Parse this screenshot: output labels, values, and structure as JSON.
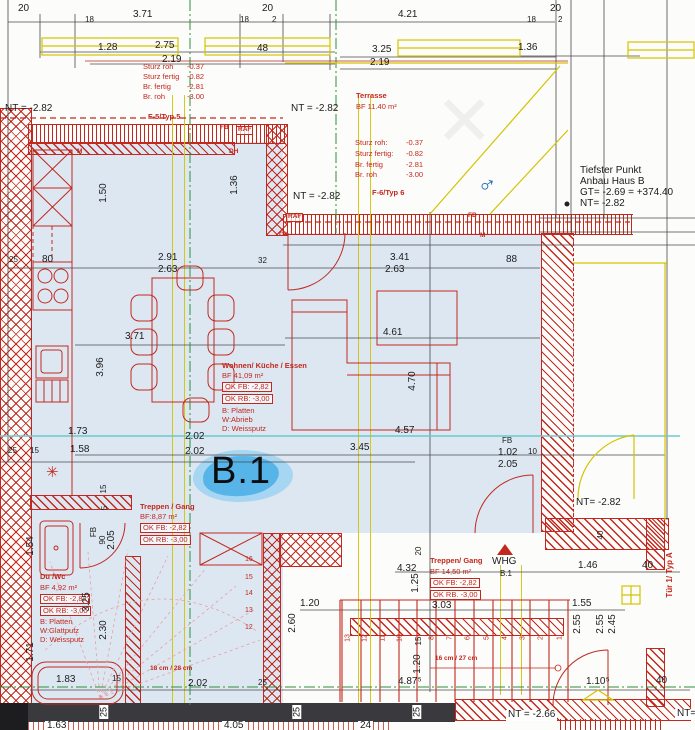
{
  "title": "Grundriss Wohnung B.1 (Erdgeschoss-Ausschnitt)",
  "colors": {
    "red": "#c2281e",
    "yellow": "#d4c400",
    "green": "#2e8f3c",
    "cyan": "#6cc9cf",
    "floor": "#dde7f2",
    "dark": "#3a3a3e",
    "blob": "#57b4e8",
    "blob_light": "#a7d6f2",
    "bluemark": "#1f6fb5"
  },
  "marker": {
    "unit_label": "B.1"
  },
  "rooms": [
    {
      "name": "Wohnen/ Küche / Essen",
      "area": "BF 41,09 m²",
      "ok_fb": "OK FB: -2,82",
      "ok_rb": "OK RB: -3,00"
    },
    {
      "name": "Treppen / Gang",
      "area": "BF:8,87 m²",
      "ok_fb": "OK FB: -2,82",
      "ok_rb": "OK RB: -3,00"
    },
    {
      "name": "Du /Wc",
      "area": "BF 4,92 m²",
      "ok_fb": "OK FB: -2,82",
      "ok_rb": "OK RB: -3,00"
    },
    {
      "name": "Treppen/ Gang",
      "area": "BF 14,50 m²",
      "ok_fb": "OK FB: -2,82",
      "ok_rb": "OK RB. -3,00"
    },
    {
      "name": "Terrasse",
      "area": "BF 11.40 m²"
    }
  ],
  "annotations": [
    {
      "n": "dim-20-topleft",
      "t": "20",
      "x": 18,
      "y": 4,
      "c": "d"
    },
    {
      "n": "dim-18",
      "t": "18",
      "x": 85,
      "y": 16,
      "c": "ds"
    },
    {
      "n": "dim-371-top",
      "t": "3.71",
      "x": 133,
      "y": 10,
      "c": "d"
    },
    {
      "n": "dim-20-mid",
      "t": "20",
      "x": 262,
      "y": 4,
      "c": "d"
    },
    {
      "n": "dim-18b",
      "t": "18",
      "x": 240,
      "y": 16,
      "c": "ds"
    },
    {
      "n": "dim-2a",
      "t": "2",
      "x": 272,
      "y": 16,
      "c": "ds"
    },
    {
      "n": "dim-421",
      "t": "4.21",
      "x": 398,
      "y": 10,
      "c": "d"
    },
    {
      "n": "dim-20-right",
      "t": "20",
      "x": 550,
      "y": 4,
      "c": "d"
    },
    {
      "n": "dim-18c",
      "t": "18",
      "x": 527,
      "y": 16,
      "c": "ds"
    },
    {
      "n": "dim-2b",
      "t": "2",
      "x": 558,
      "y": 16,
      "c": "ds"
    },
    {
      "n": "dim-128",
      "t": "1.28",
      "x": 98,
      "y": 43,
      "c": "d"
    },
    {
      "n": "dim-275",
      "t": "2.75",
      "x": 155,
      "y": 41,
      "c": "d"
    },
    {
      "n": "dim-219a",
      "t": "2.19",
      "x": 162,
      "y": 55,
      "c": "d"
    },
    {
      "n": "dim-48",
      "t": "48",
      "x": 257,
      "y": 44,
      "c": "d"
    },
    {
      "n": "dim-325",
      "t": "3.25",
      "x": 372,
      "y": 45,
      "c": "d"
    },
    {
      "n": "dim-219b",
      "t": "2.19",
      "x": 370,
      "y": 58,
      "c": "d"
    },
    {
      "n": "dim-136",
      "t": "1.36",
      "x": 518,
      "y": 43,
      "c": "d"
    },
    {
      "n": "spec1-l1",
      "t": "Sturz roh",
      "x": 143,
      "y": 63,
      "c": "r"
    },
    {
      "n": "spec1-v1",
      "t": "-0.37",
      "x": 187,
      "y": 63,
      "c": "r"
    },
    {
      "n": "spec1-l2",
      "t": "Sturz fertig",
      "x": 143,
      "y": 73,
      "c": "r"
    },
    {
      "n": "spec1-v2",
      "t": "-0.82",
      "x": 187,
      "y": 73,
      "c": "r"
    },
    {
      "n": "spec1-l3",
      "t": "Br. fertig",
      "x": 143,
      "y": 83,
      "c": "r"
    },
    {
      "n": "spec1-v3",
      "t": "-2.81",
      "x": 187,
      "y": 83,
      "c": "r"
    },
    {
      "n": "spec1-l4",
      "t": "Br. roh",
      "x": 143,
      "y": 93,
      "c": "r"
    },
    {
      "n": "spec1-v4",
      "t": "-3.00",
      "x": 187,
      "y": 93,
      "c": "r"
    },
    {
      "n": "window-type-5",
      "t": "F-5/Typ 5",
      "x": 148,
      "y": 113,
      "c": "rbold"
    },
    {
      "n": "level-nt-1",
      "t": "NT = -2.82",
      "x": 5,
      "y": 104,
      "c": "d"
    },
    {
      "n": "level-nt-2",
      "t": "NT = -2.82",
      "x": 291,
      "y": 104,
      "c": "d"
    },
    {
      "n": "room-terrasse",
      "t": "Terrasse",
      "x": 356,
      "y": 92,
      "c": "rbold"
    },
    {
      "n": "room-terrasse-area",
      "t": "BF 11.40 m²",
      "x": 356,
      "y": 103,
      "c": "r"
    },
    {
      "n": "spec2-l1",
      "t": "Sturz roh:",
      "x": 355,
      "y": 139,
      "c": "r"
    },
    {
      "n": "spec2-v1",
      "t": "-0.37",
      "x": 406,
      "y": 139,
      "c": "r"
    },
    {
      "n": "spec2-l2",
      "t": "Sturz fertig:",
      "x": 355,
      "y": 150,
      "c": "r"
    },
    {
      "n": "spec2-v2",
      "t": "-0.82",
      "x": 406,
      "y": 150,
      "c": "r"
    },
    {
      "n": "spec2-l3",
      "t": "Br. fertig",
      "x": 355,
      "y": 161,
      "c": "r"
    },
    {
      "n": "spec2-v3",
      "t": "-2.81",
      "x": 406,
      "y": 161,
      "c": "r"
    },
    {
      "n": "spec2-l4",
      "t": "Br. roh",
      "x": 355,
      "y": 171,
      "c": "r"
    },
    {
      "n": "spec2-v4",
      "t": "-3.00",
      "x": 406,
      "y": 171,
      "c": "r"
    },
    {
      "n": "window-type-6",
      "t": "F-6/Typ 6",
      "x": 372,
      "y": 189,
      "c": "rbold"
    },
    {
      "n": "level-nt-3",
      "t": "NT = -2.82",
      "x": 293,
      "y": 192,
      "c": "d"
    },
    {
      "n": "note-tiefster-1",
      "t": "Tiefster Punkt",
      "x": 580,
      "y": 166,
      "c": "d"
    },
    {
      "n": "note-tiefster-2",
      "t": "Anbau Haus B",
      "x": 580,
      "y": 177,
      "c": "d"
    },
    {
      "n": "note-tiefster-3",
      "t": "GT= -2.69 = +374.40",
      "x": 580,
      "y": 188,
      "c": "d"
    },
    {
      "n": "note-tiefster-4",
      "t": "NT= -2.82",
      "x": 580,
      "y": 199,
      "c": "d"
    },
    {
      "n": "tag-fb-1",
      "t": "FB",
      "x": 220,
      "y": 125,
      "c": "rs"
    },
    {
      "n": "tag-raf-1",
      "t": "RAF",
      "x": 236,
      "y": 126,
      "c": "rsb"
    },
    {
      "n": "tag-raf-2",
      "t": "RAF",
      "x": 286,
      "y": 213,
      "c": "rsb"
    },
    {
      "n": "tag-fb-2",
      "t": "FB",
      "x": 468,
      "y": 213,
      "c": "rs"
    },
    {
      "n": "tag-ok",
      "t": "OK",
      "x": 279,
      "y": 232,
      "c": "rs"
    },
    {
      "n": "tag-m-1",
      "t": "M",
      "x": 480,
      "y": 233,
      "c": "rs"
    },
    {
      "n": "tag-m-2",
      "t": "M",
      "x": 77,
      "y": 149,
      "c": "rs"
    },
    {
      "n": "tag-dh",
      "t": "DH",
      "x": 229,
      "y": 149,
      "c": "rs"
    },
    {
      "n": "dim-25a",
      "t": "25",
      "x": 9,
      "y": 256,
      "c": "ds"
    },
    {
      "n": "dim-80",
      "t": "80",
      "x": 42,
      "y": 255,
      "c": "d"
    },
    {
      "n": "dim-291",
      "t": "2.91",
      "x": 158,
      "y": 253,
      "c": "d"
    },
    {
      "n": "dim-263a",
      "t": "2.63",
      "x": 158,
      "y": 265,
      "c": "d"
    },
    {
      "n": "dim-32",
      "t": "32",
      "x": 258,
      "y": 257,
      "c": "ds"
    },
    {
      "n": "dim-341",
      "t": "3.41",
      "x": 390,
      "y": 253,
      "c": "d"
    },
    {
      "n": "dim-263b",
      "t": "2.63",
      "x": 385,
      "y": 265,
      "c": "d"
    },
    {
      "n": "dim-88",
      "t": "88",
      "x": 506,
      "y": 255,
      "c": "d"
    },
    {
      "n": "dim-150-v",
      "t": "1.50",
      "x": 104,
      "y": 193,
      "c": "dv"
    },
    {
      "n": "dim-136-v",
      "t": "1.36",
      "x": 235,
      "y": 185,
      "c": "dv"
    },
    {
      "n": "dim-371-mid",
      "t": "3.71",
      "x": 125,
      "y": 332,
      "c": "d"
    },
    {
      "n": "dim-396-v",
      "t": "3.96",
      "x": 101,
      "y": 367,
      "c": "dv"
    },
    {
      "n": "dim-461",
      "t": "4.61",
      "x": 383,
      "y": 328,
      "c": "d"
    },
    {
      "n": "dim-470-v",
      "t": "4.70",
      "x": 413,
      "y": 381,
      "c": "dv"
    },
    {
      "n": "room-wohnen",
      "t": "Wohnen/ Küche / Essen",
      "x": 222,
      "y": 362,
      "c": "rbold"
    },
    {
      "n": "room-wohnen-area",
      "t": "BF 41,09 m²",
      "x": 222,
      "y": 372,
      "c": "r"
    },
    {
      "n": "room-wohnen-okfb",
      "t": "OK FB: -2,82",
      "x": 222,
      "y": 382,
      "c": "rb"
    },
    {
      "n": "room-wohnen-okrb",
      "t": "OK RB: -3,00",
      "x": 222,
      "y": 394,
      "c": "rb"
    },
    {
      "n": "room-wohnen-b",
      "t": "B: Platten",
      "x": 222,
      "y": 407,
      "c": "r"
    },
    {
      "n": "room-wohnen-w",
      "t": "W:Abrieb",
      "x": 222,
      "y": 416,
      "c": "r"
    },
    {
      "n": "room-wohnen-d",
      "t": "D: Weissputz",
      "x": 222,
      "y": 425,
      "c": "r"
    },
    {
      "n": "dim-173",
      "t": "1.73",
      "x": 68,
      "y": 427,
      "c": "d"
    },
    {
      "n": "dim-457",
      "t": "4.57",
      "x": 395,
      "y": 426,
      "c": "d"
    },
    {
      "n": "dim-25b",
      "t": "25",
      "x": 8,
      "y": 447,
      "c": "ds"
    },
    {
      "n": "dim-15a",
      "t": "15",
      "x": 30,
      "y": 447,
      "c": "ds"
    },
    {
      "n": "dim-158",
      "t": "1.58",
      "x": 70,
      "y": 445,
      "c": "d"
    },
    {
      "n": "dim-202a",
      "t": "2.02",
      "x": 185,
      "y": 432,
      "c": "d"
    },
    {
      "n": "dim-202b",
      "t": "2.02",
      "x": 185,
      "y": 447,
      "c": "d"
    },
    {
      "n": "dim-345",
      "t": "3.45",
      "x": 350,
      "y": 443,
      "c": "d"
    },
    {
      "n": "tag-fb-3",
      "t": "FB",
      "x": 502,
      "y": 437,
      "c": "ds"
    },
    {
      "n": "dim-102",
      "t": "1.02",
      "x": 498,
      "y": 448,
      "c": "d"
    },
    {
      "n": "dim-10",
      "t": "10",
      "x": 528,
      "y": 448,
      "c": "ds"
    },
    {
      "n": "dim-205",
      "t": "2.05",
      "x": 498,
      "y": 460,
      "c": "d"
    },
    {
      "n": "unit-marker",
      "t": "B.1",
      "x": 211,
      "y": 452,
      "c": "big"
    },
    {
      "n": "room-treppen1",
      "t": "Treppen / Gang",
      "x": 140,
      "y": 503,
      "c": "rbold"
    },
    {
      "n": "room-treppen1-area",
      "t": "BF:8,87 m²",
      "x": 140,
      "y": 513,
      "c": "r"
    },
    {
      "n": "room-treppen1-okfb",
      "t": "OK FB: -2,82",
      "x": 140,
      "y": 523,
      "c": "rb"
    },
    {
      "n": "room-treppen1-okrb",
      "t": "OK RB: -3,00",
      "x": 140,
      "y": 535,
      "c": "rb"
    },
    {
      "n": "dim-15-v1",
      "t": "15",
      "x": 104,
      "y": 489,
      "c": "dvs"
    },
    {
      "n": "dim-5-v",
      "t": "5",
      "x": 105,
      "y": 508,
      "c": "dvs"
    },
    {
      "n": "tag-fb-4",
      "t": "FB",
      "x": 94,
      "y": 532,
      "c": "dvs"
    },
    {
      "n": "dim-90-v",
      "t": "90",
      "x": 103,
      "y": 540,
      "c": "dvs"
    },
    {
      "n": "dim-205-v",
      "t": "2.05",
      "x": 112,
      "y": 540,
      "c": "dv"
    },
    {
      "n": "dim-154-v",
      "t": "1.54",
      "x": 31,
      "y": 546,
      "c": "dv"
    },
    {
      "n": "room-duwc",
      "t": "Du /Wc",
      "x": 40,
      "y": 573,
      "c": "rbold"
    },
    {
      "n": "room-duwc-area",
      "t": "BF 4,92 m²",
      "x": 40,
      "y": 584,
      "c": "r"
    },
    {
      "n": "room-duwc-okfb",
      "t": "OK FB: -2,82",
      "x": 40,
      "y": 594,
      "c": "rb"
    },
    {
      "n": "room-duwc-okrb",
      "t": "OK RB: -3,00",
      "x": 40,
      "y": 606,
      "c": "rb"
    },
    {
      "n": "room-duwc-b",
      "t": "B: Platten",
      "x": 40,
      "y": 618,
      "c": "r"
    },
    {
      "n": "room-duwc-w",
      "t": "W:Glattputz",
      "x": 40,
      "y": 627,
      "c": "r"
    },
    {
      "n": "room-duwc-d",
      "t": "D: Weissputz",
      "x": 40,
      "y": 636,
      "c": "r"
    },
    {
      "n": "dim-325-v",
      "t": "3.25",
      "x": 87,
      "y": 602,
      "c": "dv"
    },
    {
      "n": "dim-230-v",
      "t": "2.30",
      "x": 104,
      "y": 630,
      "c": "dv"
    },
    {
      "n": "dim-171-v",
      "t": "1.71",
      "x": 31,
      "y": 652,
      "c": "dv"
    },
    {
      "n": "stair-note-left",
      "t": "18 cm / 28 cm",
      "x": 150,
      "y": 666,
      "c": "rs"
    },
    {
      "n": "dim-183",
      "t": "1.83",
      "x": 56,
      "y": 675,
      "c": "d"
    },
    {
      "n": "dim-15b",
      "t": "15",
      "x": 112,
      "y": 675,
      "c": "ds"
    },
    {
      "n": "dim-202c",
      "t": "2.02",
      "x": 188,
      "y": 679,
      "c": "d"
    },
    {
      "n": "dim-25c",
      "t": "25",
      "x": 258,
      "y": 679,
      "c": "ds"
    },
    {
      "n": "dim-4875",
      "t": "4.87⁵",
      "x": 398,
      "y": 677,
      "c": "d"
    },
    {
      "n": "dim-1105",
      "t": "1.10⁵",
      "x": 586,
      "y": 677,
      "c": "d"
    },
    {
      "n": "dim-40a",
      "t": "40",
      "x": 656,
      "y": 676,
      "c": "d"
    },
    {
      "n": "dim-432",
      "t": "4.32",
      "x": 397,
      "y": 564,
      "c": "d"
    },
    {
      "n": "dim-125-v",
      "t": "1.25",
      "x": 416,
      "y": 583,
      "c": "dv"
    },
    {
      "n": "dim-120a",
      "t": "1.20",
      "x": 300,
      "y": 599,
      "c": "d"
    },
    {
      "n": "dim-260-v",
      "t": "2.60",
      "x": 293,
      "y": 623,
      "c": "dv"
    },
    {
      "n": "room-treppen2",
      "t": "Treppen/ Gang",
      "x": 430,
      "y": 557,
      "c": "rbold"
    },
    {
      "n": "room-treppen2-area",
      "t": "BF 14,50 m²",
      "x": 430,
      "y": 568,
      "c": "r"
    },
    {
      "n": "room-treppen2-okfb",
      "t": "OK FB: -2,82",
      "x": 430,
      "y": 578,
      "c": "rb"
    },
    {
      "n": "room-treppen2-okrb",
      "t": "OK RB. -3,00",
      "x": 430,
      "y": 590,
      "c": "rb"
    },
    {
      "n": "tag-whg",
      "t": "WHG",
      "x": 492,
      "y": 557,
      "c": "d"
    },
    {
      "n": "tag-whg-unit",
      "t": "B.1",
      "x": 500,
      "y": 570,
      "c": "ds"
    },
    {
      "n": "dim-303",
      "t": "3.03",
      "x": 432,
      "y": 601,
      "c": "d"
    },
    {
      "n": "dim-146",
      "t": "1.46",
      "x": 578,
      "y": 561,
      "c": "d"
    },
    {
      "n": "dim-40b",
      "t": "40",
      "x": 642,
      "y": 561,
      "c": "d"
    },
    {
      "n": "dim-155",
      "t": "1.55",
      "x": 572,
      "y": 599,
      "c": "d"
    },
    {
      "n": "dim-255-v1",
      "t": "2.55",
      "x": 578,
      "y": 624,
      "c": "dv"
    },
    {
      "n": "dim-255-v2",
      "t": "2.55",
      "x": 601,
      "y": 624,
      "c": "dv"
    },
    {
      "n": "dim-245-v",
      "t": "2.45",
      "x": 613,
      "y": 624,
      "c": "dv"
    },
    {
      "n": "dim-40-v",
      "t": "40",
      "x": 601,
      "y": 535,
      "c": "dvs"
    },
    {
      "n": "level-nt-4",
      "t": "NT= -2.82",
      "x": 576,
      "y": 498,
      "c": "d"
    },
    {
      "n": "door-type-a",
      "t": "Tür 1/ Typ A",
      "x": 670,
      "y": 575,
      "c": "rv"
    },
    {
      "n": "stair-note-right",
      "t": "16 cm / 27 cm",
      "x": 435,
      "y": 656,
      "c": "rs"
    },
    {
      "n": "level-nt-5",
      "t": "NT = -2.66",
      "x": 506,
      "y": 710,
      "c": "d bgw"
    },
    {
      "n": "level-nt-6",
      "t": "NT=",
      "x": 675,
      "y": 709,
      "c": "d bgw"
    },
    {
      "n": "dim-20-v",
      "t": "20",
      "x": 419,
      "y": 551,
      "c": "dvs"
    },
    {
      "n": "dim-15-v2",
      "t": "15",
      "x": 419,
      "y": 641,
      "c": "dvs"
    },
    {
      "n": "dim-120-v",
      "t": "1.20",
      "x": 418,
      "y": 664,
      "c": "dv"
    },
    {
      "n": "band-25-1",
      "t": "25",
      "x": 104,
      "y": 712,
      "c": "wb"
    },
    {
      "n": "band-25-2",
      "t": "25",
      "x": 297,
      "y": 712,
      "c": "wb"
    },
    {
      "n": "band-25-3",
      "t": "25",
      "x": 417,
      "y": 712,
      "c": "wb"
    },
    {
      "n": "dim-163-clip",
      "t": "1.63",
      "x": 45,
      "y": 721,
      "c": "d bgw"
    },
    {
      "n": "dim-405-clip",
      "t": "4.05",
      "x": 222,
      "y": 721,
      "c": "d bgw"
    },
    {
      "n": "dim-24-clip",
      "t": "24",
      "x": 358,
      "y": 721,
      "c": "d bgw"
    },
    {
      "n": "mark-male-symbol",
      "t": "♂",
      "x": 478,
      "y": 172,
      "c": "bluemark"
    },
    {
      "n": "mark-asterisk",
      "t": "✳",
      "x": 46,
      "y": 465,
      "c": "rast"
    },
    {
      "n": "step-1",
      "t": "1",
      "x": 560,
      "y": 638,
      "c": "stepv"
    },
    {
      "n": "step-2",
      "t": "2",
      "x": 541,
      "y": 638,
      "c": "stepv"
    },
    {
      "n": "step-3",
      "t": "3",
      "x": 523,
      "y": 638,
      "c": "stepv"
    },
    {
      "n": "step-4",
      "t": "4",
      "x": 505,
      "y": 638,
      "c": "stepv"
    },
    {
      "n": "step-5",
      "t": "5",
      "x": 487,
      "y": 638,
      "c": "stepv"
    },
    {
      "n": "step-6",
      "t": "6",
      "x": 468,
      "y": 638,
      "c": "stepv"
    },
    {
      "n": "step-7",
      "t": "7",
      "x": 450,
      "y": 638,
      "c": "stepv"
    },
    {
      "n": "step-8",
      "t": "8",
      "x": 432,
      "y": 638,
      "c": "stepv"
    },
    {
      "n": "step-10",
      "t": "10",
      "x": 400,
      "y": 638,
      "c": "stepv"
    },
    {
      "n": "step-11",
      "t": "11",
      "x": 383,
      "y": 638,
      "c": "stepv"
    },
    {
      "n": "step-12",
      "t": "12",
      "x": 365,
      "y": 638,
      "c": "stepv"
    },
    {
      "n": "step-13",
      "t": "13",
      "x": 348,
      "y": 638,
      "c": "stepv"
    },
    {
      "n": "step-16l",
      "t": "16",
      "x": 245,
      "y": 556,
      "c": "steph"
    },
    {
      "n": "step-15l",
      "t": "15",
      "x": 245,
      "y": 574,
      "c": "steph"
    },
    {
      "n": "step-14l",
      "t": "14",
      "x": 245,
      "y": 590,
      "c": "steph"
    },
    {
      "n": "step-13l",
      "t": "13",
      "x": 245,
      "y": 607,
      "c": "steph"
    },
    {
      "n": "step-12l",
      "t": "12",
      "x": 245,
      "y": 624,
      "c": "steph"
    },
    {
      "n": "watermark-x",
      "t": "✕",
      "x": 435,
      "y": 85,
      "c": "wm"
    }
  ]
}
